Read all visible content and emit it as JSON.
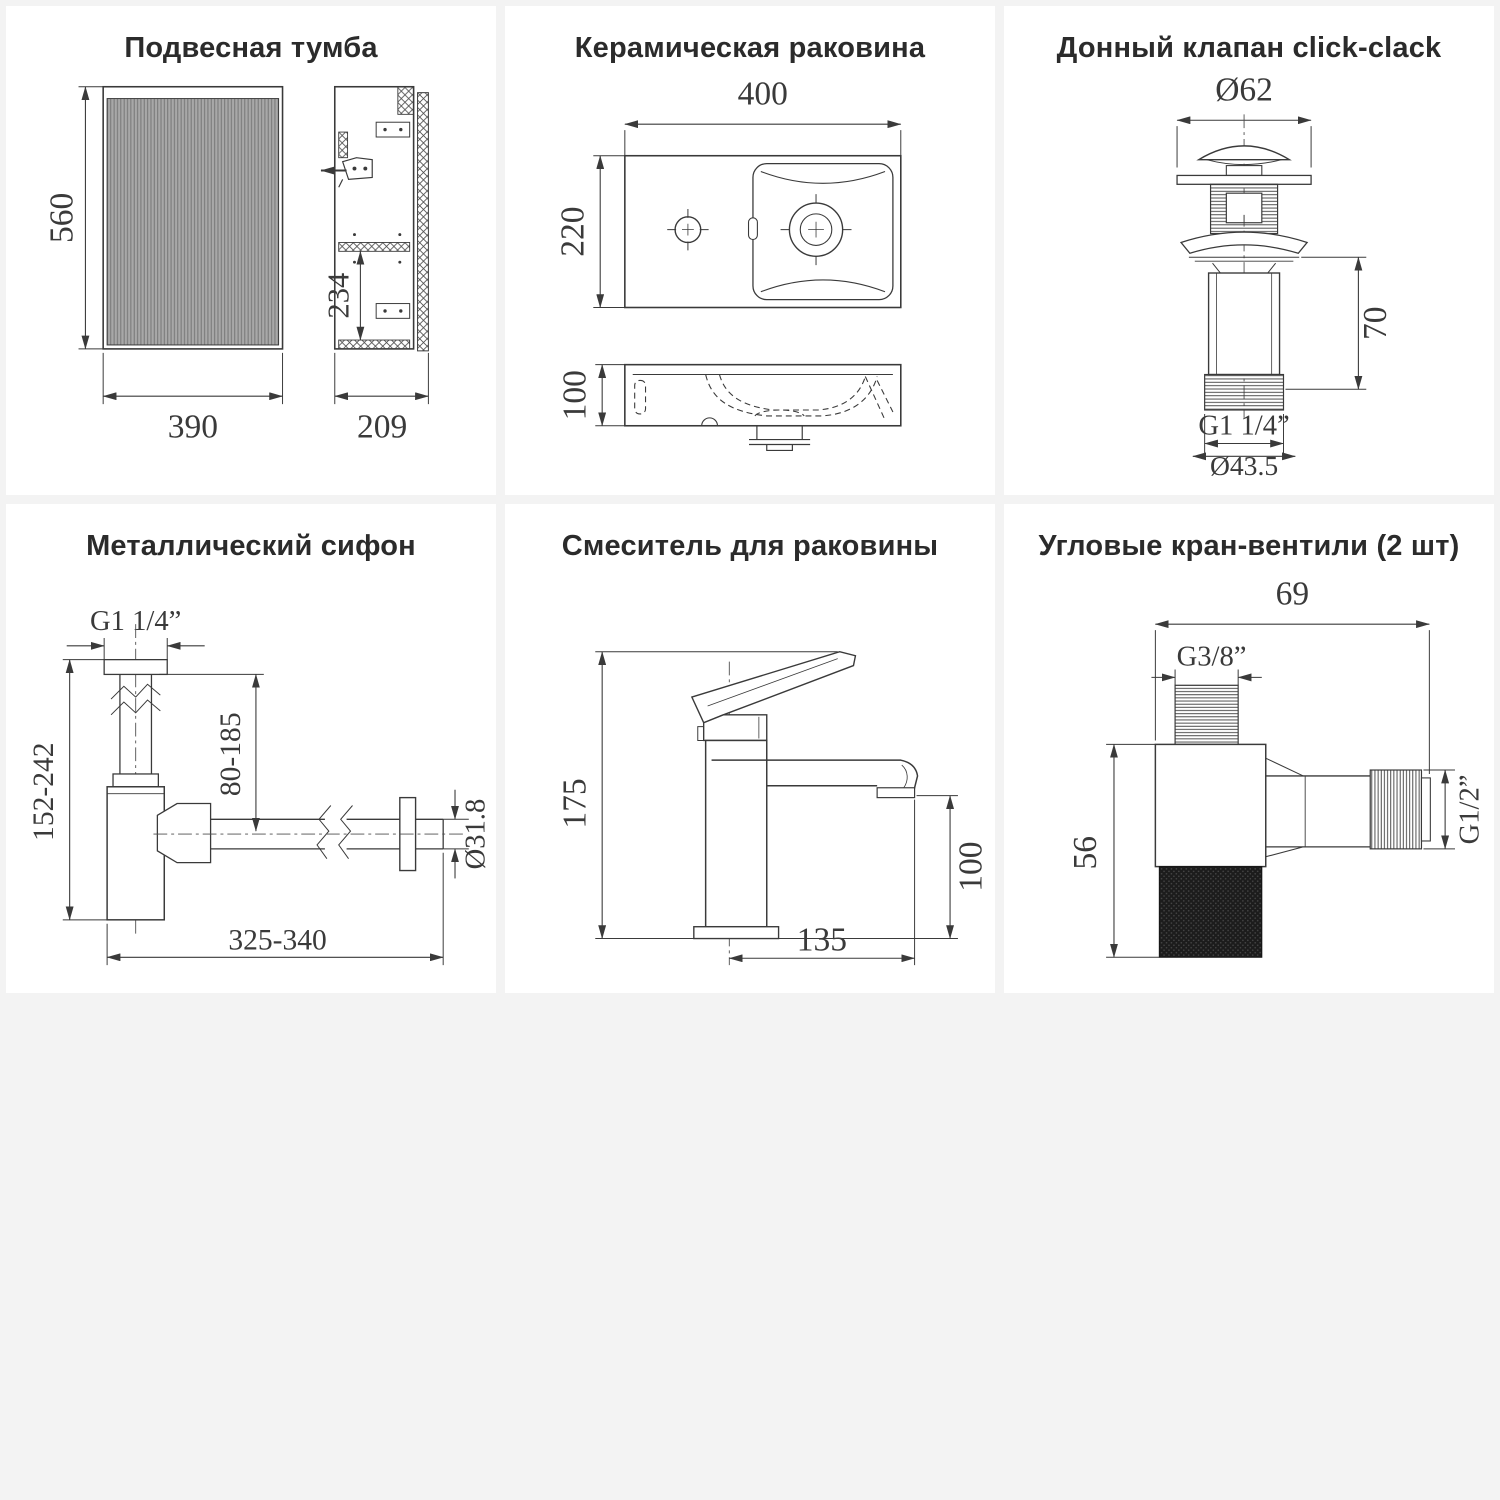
{
  "colors": {
    "page_background": "#f3f3f3",
    "card_background": "#ffffff",
    "line": "#3a3a3a",
    "title_text": "#2b2b2b",
    "ribbed_fill": "#a8a8a8",
    "knurl_fill": "#1c1c1c"
  },
  "panels": {
    "cabinet": {
      "title": "Подвесная тумба",
      "dim_height": "560",
      "dim_width": "390",
      "dim_depth": "209",
      "dim_shelf": "234"
    },
    "sink": {
      "title": "Керамическая раковина",
      "dim_width": "400",
      "dim_depth": "220",
      "dim_height": "100"
    },
    "drain_valve": {
      "title": "Донный клапан click-clack",
      "dim_cap_diameter": "Ø62",
      "dim_body_height": "70",
      "thread_label": "G1 1/4”",
      "dim_outlet_diameter": "Ø43.5"
    },
    "siphon": {
      "title": "Металлический сифон",
      "thread_label": "G1 1/4”",
      "dim_inlet_height": "80-185",
      "dim_total_height": "152-242",
      "dim_length": "325-340",
      "dim_pipe_diameter": "Ø31.8"
    },
    "mixer": {
      "title": "Смеситель для раковины",
      "dim_height": "175",
      "dim_spout_height": "100",
      "dim_spout_reach": "135"
    },
    "angle_valve": {
      "title": "Угловые кран-вентили (2 шт)",
      "dim_width": "69",
      "thread_inlet": "G3/8”",
      "dim_height": "56",
      "thread_outlet": "G1/2”"
    }
  }
}
